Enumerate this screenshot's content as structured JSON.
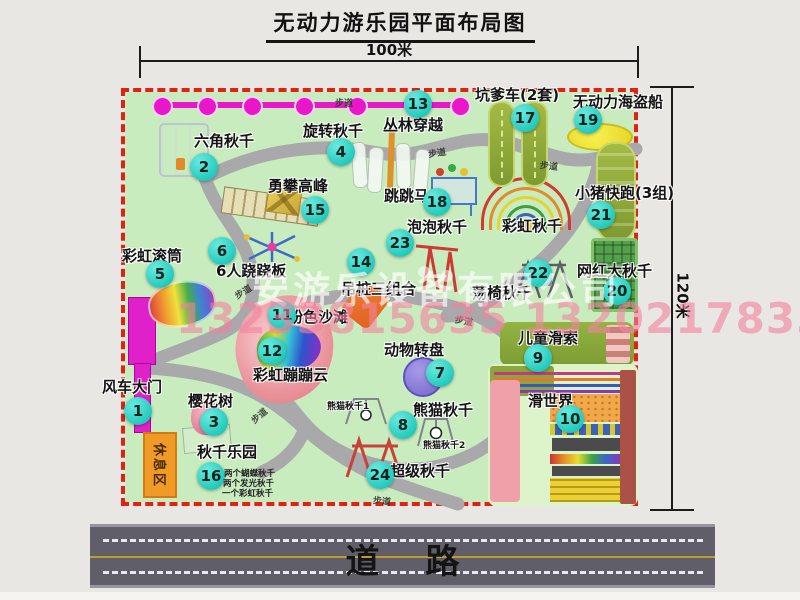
{
  "title": "无动力游乐园平面布局图",
  "dim_width": "100米",
  "dim_height": "120米",
  "road_label": "道路",
  "path_label": "步道",
  "rest_area": "休息区",
  "rainbow_swing": "彩虹秋千",
  "panda_swing_1": "熊猫秋千1",
  "panda_swing_2": "熊猫秋千2",
  "swing_park_notes": [
    "两个蝴蝶秋千",
    "两个发光秋千",
    "一个彩虹秋千"
  ],
  "watermark": {
    "company": "安游乐设备有限公司",
    "phones": "13233815635 13202178333"
  },
  "colors": {
    "map_green": "#c9ecbf",
    "border_red": "#df2312",
    "badge_teal": "#1fc8ba",
    "chain_magenta": "#ea16ca",
    "road_gray": "#605e68"
  },
  "attractions": [
    {
      "num": "1",
      "label": "风车大门"
    },
    {
      "num": "2",
      "label": "六角秋千"
    },
    {
      "num": "3",
      "label": "樱花树"
    },
    {
      "num": "4",
      "label": "旋转秋千"
    },
    {
      "num": "5",
      "label": "彩虹滚筒"
    },
    {
      "num": "6",
      "label": "6人跷跷板"
    },
    {
      "num": "7",
      "label": "动物转盘"
    },
    {
      "num": "8",
      "label": "熊猫秋千"
    },
    {
      "num": "9",
      "label": "儿童滑索"
    },
    {
      "num": "10",
      "label": "滑世界"
    },
    {
      "num": "11",
      "label": "粉色沙滩"
    },
    {
      "num": "12",
      "label": "彩虹蹦蹦云"
    },
    {
      "num": "13",
      "label": "丛林穿越"
    },
    {
      "num": "14",
      "label": "吊桩三组合"
    },
    {
      "num": "15",
      "label": "勇攀高峰"
    },
    {
      "num": "16",
      "label": "秋千乐园"
    },
    {
      "num": "17",
      "label": "坑爹车(2套)"
    },
    {
      "num": "18",
      "label": "跳跳马"
    },
    {
      "num": "19",
      "label": "无动力海盗船"
    },
    {
      "num": "20",
      "label": "网红大秋千"
    },
    {
      "num": "21",
      "label": "小猪快跑(3组)"
    },
    {
      "num": "22",
      "label": "荡椅秋千"
    },
    {
      "num": "23",
      "label": "泡泡秋千"
    },
    {
      "num": "24",
      "label": "超级秋千"
    }
  ]
}
